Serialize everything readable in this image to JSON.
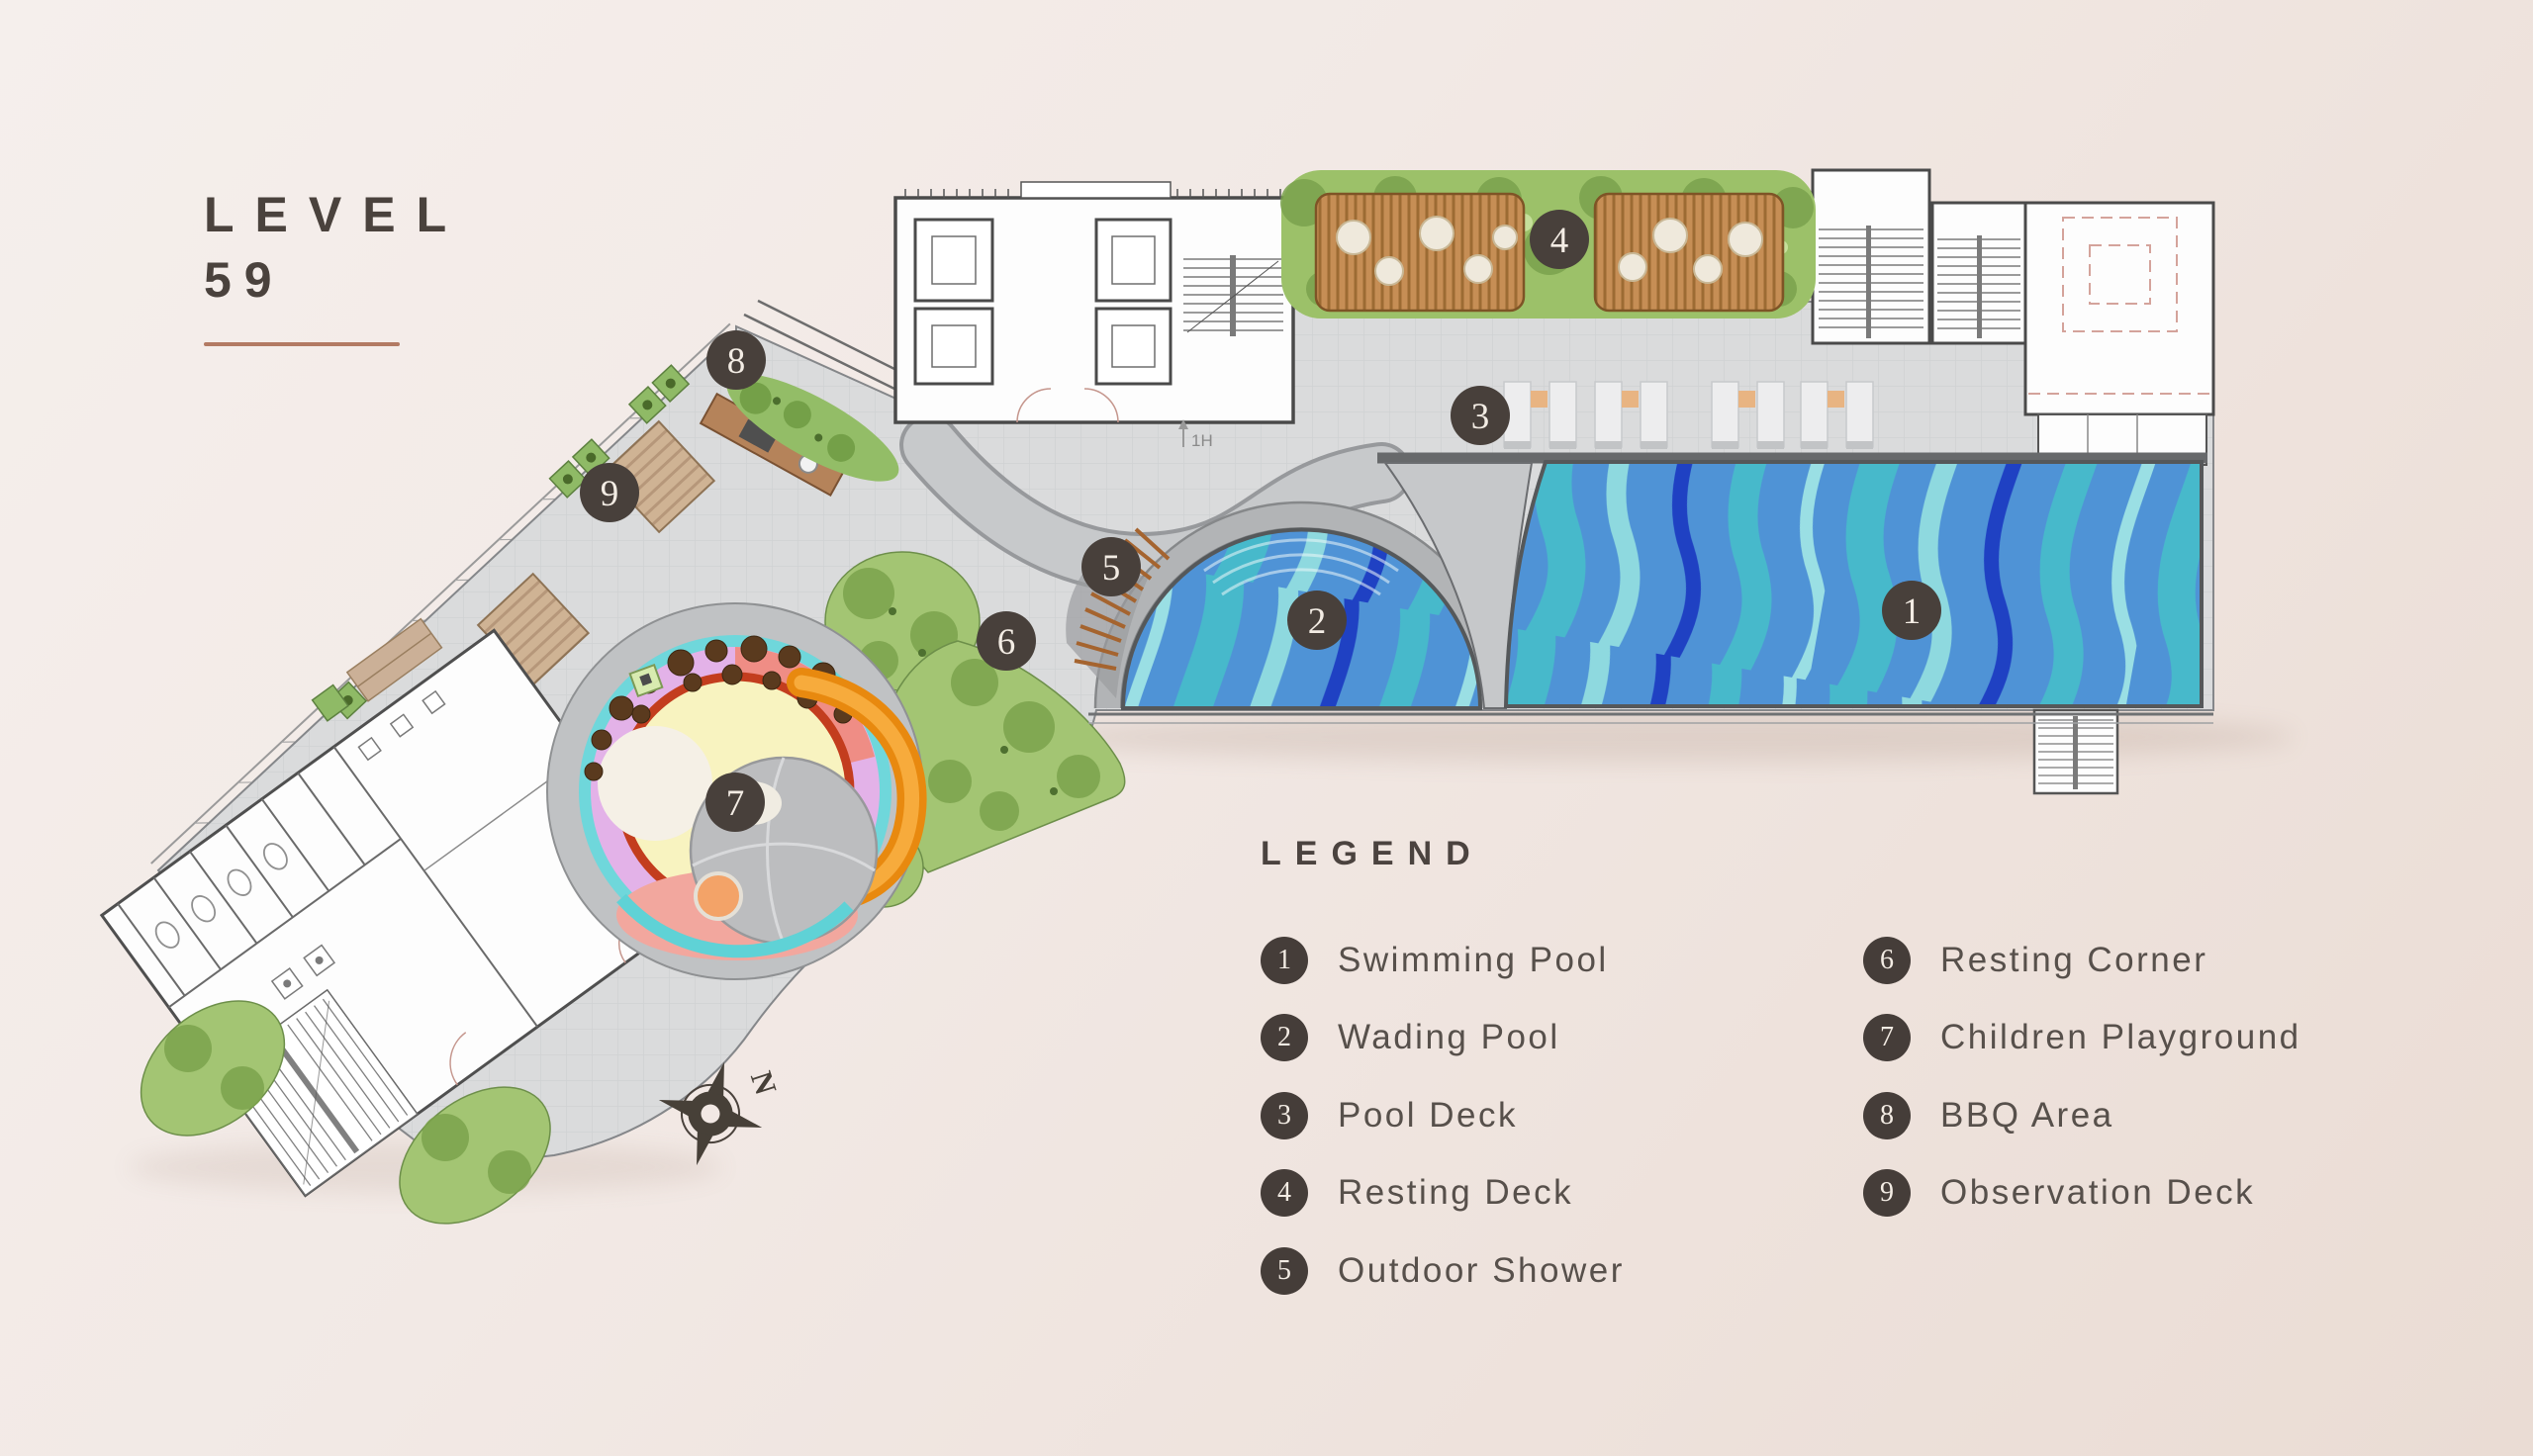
{
  "title": {
    "line1": "LEVEL",
    "line2": "59"
  },
  "legend": {
    "heading": "LEGEND",
    "items": [
      {
        "number": "1",
        "label": "Swimming Pool"
      },
      {
        "number": "2",
        "label": "Wading Pool"
      },
      {
        "number": "3",
        "label": "Pool Deck"
      },
      {
        "number": "4",
        "label": "Resting Deck"
      },
      {
        "number": "5",
        "label": "Outdoor Shower"
      },
      {
        "number": "6",
        "label": "Resting Corner"
      },
      {
        "number": "7",
        "label": "Children Playground"
      },
      {
        "number": "8",
        "label": "BBQ Area"
      },
      {
        "number": "9",
        "label": "Observation Deck"
      }
    ]
  },
  "markers": [
    {
      "number": "1",
      "area": "Swimming Pool"
    },
    {
      "number": "2",
      "area": "Wading Pool"
    },
    {
      "number": "3",
      "area": "Pool Deck"
    },
    {
      "number": "4",
      "area": "Resting Deck"
    },
    {
      "number": "5",
      "area": "Outdoor Shower"
    },
    {
      "number": "6",
      "area": "Resting Corner"
    },
    {
      "number": "7",
      "area": "Children Playground"
    },
    {
      "number": "8",
      "area": "BBQ Area"
    },
    {
      "number": "9",
      "area": "Observation Deck"
    }
  ],
  "compass": {
    "north_label": "N"
  },
  "plan_notes": {
    "stair_note": "1H"
  },
  "colors": {
    "background": "#f1e9e5",
    "title_text": "#4a423d",
    "accent_underline": "#b27a63",
    "badge": "#453d39",
    "legend_text": "#57504b",
    "pool_base": "#4f93d6",
    "pool_wave_teal": "#47b9cb",
    "pool_wave_light": "#8ed9df",
    "pool_wave_deep": "#1f41c3",
    "deck_gray": "#dadbdc",
    "greenery": "#a3c573",
    "wood": "#c68e55"
  }
}
